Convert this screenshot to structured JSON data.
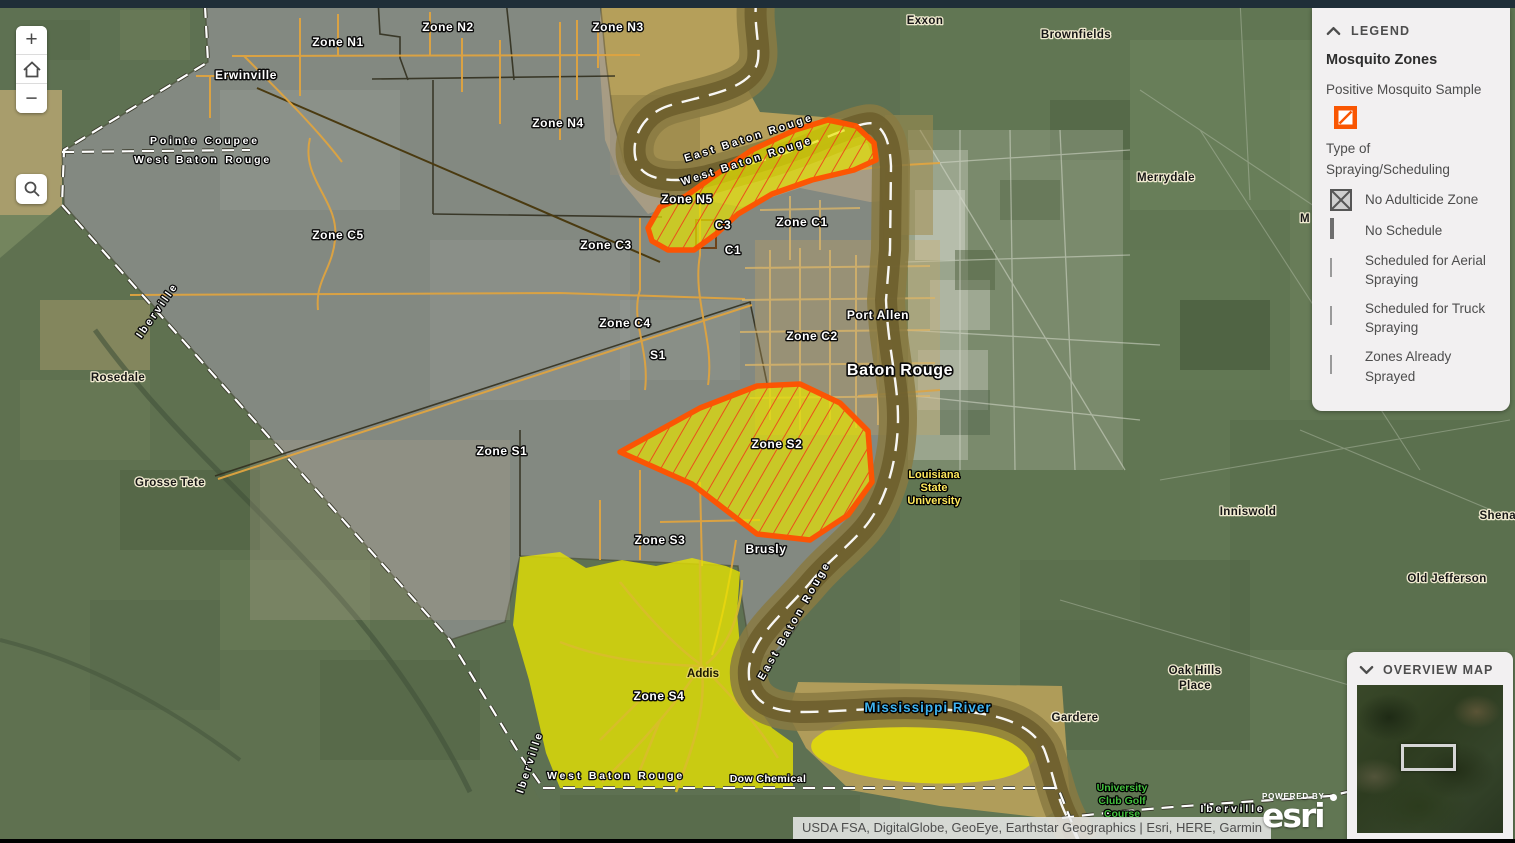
{
  "colors": {
    "topbar": "#1f2e38",
    "panel_bg": "#f2f0f1",
    "panel_text": "#4d4d4d",
    "title_text": "#2e2e2e",
    "positive_orange": "#f95602",
    "zone_outline_orange": "#ff5400",
    "hatch_red": "#ee4e18",
    "truck_yellow": "#e8e400",
    "legend_truck_yellow": "#eae67c",
    "aerial_blue": "#79a6e8",
    "sprayed_green": "#8fd95a",
    "no_schedule_gray": "#c9c9c9",
    "swatch_border": "#6e6e6e",
    "crosshatch_gray": "#565656",
    "road_orange": "#dfa440",
    "river_sand": "#c4a75c",
    "river_water": "#6e5f2e",
    "base_green": "#5e7152",
    "attr_bg": "#e8e8e8",
    "water_label_blue": "#3fb3f0"
  },
  "controls": {
    "zoom_in_label": "+",
    "zoom_out_label": "−"
  },
  "legend": {
    "header": "LEGEND",
    "layer_title": "Mosquito Zones",
    "positive_sample_label": "Positive Mosquito Sample",
    "group_title": "Type of Spraying/Scheduling",
    "items": [
      {
        "label": "No Adulticide Zone",
        "swatch": "crosshatch"
      },
      {
        "label": "No Schedule",
        "swatch": "no-schedule"
      },
      {
        "label": "Scheduled for Aerial Spraying",
        "swatch": "aerial"
      },
      {
        "label": "Scheduled for Truck Spraying",
        "swatch": "truck"
      },
      {
        "label": "Zones Already Sprayed",
        "swatch": "sprayed"
      }
    ]
  },
  "overview": {
    "header": "OVERVIEW MAP"
  },
  "attribution": {
    "text": "USDA FSA, DigitalGlobe, GeoEye, Earthstar Geographics  |  Esri, HERE, Garmin"
  },
  "brand": {
    "powered_by": "POWERED BY",
    "name": "esri"
  },
  "map_labels": [
    {
      "t": "Zone N1",
      "x": 338,
      "y": 46,
      "c": "zone"
    },
    {
      "t": "Zone N2",
      "x": 448,
      "y": 31,
      "c": "zone"
    },
    {
      "t": "Zone N3",
      "x": 618,
      "y": 31,
      "c": "zone"
    },
    {
      "t": "Zone N4",
      "x": 558,
      "y": 127,
      "c": "zone"
    },
    {
      "t": "Zone N5",
      "x": 687,
      "y": 203,
      "c": "zone"
    },
    {
      "t": "C3",
      "x": 723,
      "y": 229,
      "c": "zone"
    },
    {
      "t": "C1",
      "x": 733,
      "y": 254,
      "c": "zone"
    },
    {
      "t": "Zone C1",
      "x": 802,
      "y": 226,
      "c": "zone"
    },
    {
      "t": "Zone C5",
      "x": 338,
      "y": 239,
      "c": "zone"
    },
    {
      "t": "Zone C3",
      "x": 606,
      "y": 249,
      "c": "zone"
    },
    {
      "t": "Zone C4",
      "x": 625,
      "y": 327,
      "c": "zone"
    },
    {
      "t": "S1",
      "x": 658,
      "y": 359,
      "c": "zone"
    },
    {
      "t": "Zone C2",
      "x": 812,
      "y": 340,
      "c": "zone"
    },
    {
      "t": "Zone S1",
      "x": 502,
      "y": 455,
      "c": "zone"
    },
    {
      "t": "Zone S2",
      "x": 777,
      "y": 448,
      "c": "zone"
    },
    {
      "t": "Zone S3",
      "x": 660,
      "y": 544,
      "c": "zone"
    },
    {
      "t": "Zone S4",
      "x": 659,
      "y": 700,
      "c": "zone"
    },
    {
      "t": "Erwinville",
      "x": 246,
      "y": 79,
      "c": "zone"
    },
    {
      "t": "Port Allen",
      "x": 878,
      "y": 319,
      "c": "zone"
    },
    {
      "t": "Baton Rouge",
      "x": 900,
      "y": 375,
      "c": "zonebig"
    },
    {
      "t": "Brusly",
      "x": 766,
      "y": 553,
      "c": "zone"
    },
    {
      "t": "Dow Chemical",
      "x": 768,
      "y": 782,
      "c": "zone-sm"
    },
    {
      "t": "Pointe Coupee",
      "x": 205,
      "y": 144,
      "c": "county"
    },
    {
      "t": "West Baton Rouge",
      "x": 203,
      "y": 163,
      "c": "county"
    },
    {
      "t": "East Baton Rouge",
      "x": 750,
      "y": 141,
      "c": "county",
      "r": -18
    },
    {
      "t": "West Baton Rouge",
      "x": 748,
      "y": 164,
      "c": "county",
      "r": -18
    },
    {
      "t": "East Baton Rouge",
      "x": 797,
      "y": 622,
      "c": "county",
      "r": -60
    },
    {
      "t": "Iberville",
      "x": 533,
      "y": 763,
      "c": "county",
      "r": -72
    },
    {
      "t": "Iberville",
      "x": 160,
      "y": 312,
      "c": "county",
      "r": -55
    },
    {
      "t": "West Baton Rouge",
      "x": 616,
      "y": 779,
      "c": "county"
    },
    {
      "t": "Iberville",
      "x": 1233,
      "y": 812,
      "c": "county"
    },
    {
      "t": "Exxon",
      "x": 925,
      "y": 24,
      "c": "place"
    },
    {
      "t": "Brownfields",
      "x": 1076,
      "y": 38,
      "c": "place"
    },
    {
      "t": "Merrydale",
      "x": 1166,
      "y": 181,
      "c": "place"
    },
    {
      "t": "M",
      "x": 1305,
      "y": 222,
      "c": "place"
    },
    {
      "t": "Rosedale",
      "x": 118,
      "y": 381,
      "c": "place"
    },
    {
      "t": "Grosse Tete",
      "x": 170,
      "y": 486,
      "c": "place"
    },
    {
      "t": "Inniswold",
      "x": 1248,
      "y": 515,
      "c": "place"
    },
    {
      "t": "Shenandoah",
      "x": 1516,
      "y": 519,
      "c": "place"
    },
    {
      "t": "Old Jefferson",
      "x": 1447,
      "y": 582,
      "c": "place"
    },
    {
      "t": "Oak Hills",
      "x": 1195,
      "y": 674,
      "c": "place"
    },
    {
      "t": "Place",
      "x": 1195,
      "y": 689,
      "c": "place"
    },
    {
      "t": "Gardere",
      "x": 1075,
      "y": 721,
      "c": "place"
    },
    {
      "t": "Addis",
      "x": 703,
      "y": 677,
      "c": "addis"
    },
    {
      "t": "Louisiana",
      "x": 934,
      "y": 478,
      "c": "lsu"
    },
    {
      "t": "State",
      "x": 934,
      "y": 491,
      "c": "lsu"
    },
    {
      "t": "University",
      "x": 934,
      "y": 504,
      "c": "lsu"
    },
    {
      "t": "University",
      "x": 1122,
      "y": 791,
      "c": "golf"
    },
    {
      "t": "Club Golf",
      "x": 1122,
      "y": 804,
      "c": "golf"
    },
    {
      "t": "Course",
      "x": 1122,
      "y": 817,
      "c": "golf"
    },
    {
      "t": "Mississippi River",
      "x": 928,
      "y": 712,
      "c": "water"
    }
  ]
}
